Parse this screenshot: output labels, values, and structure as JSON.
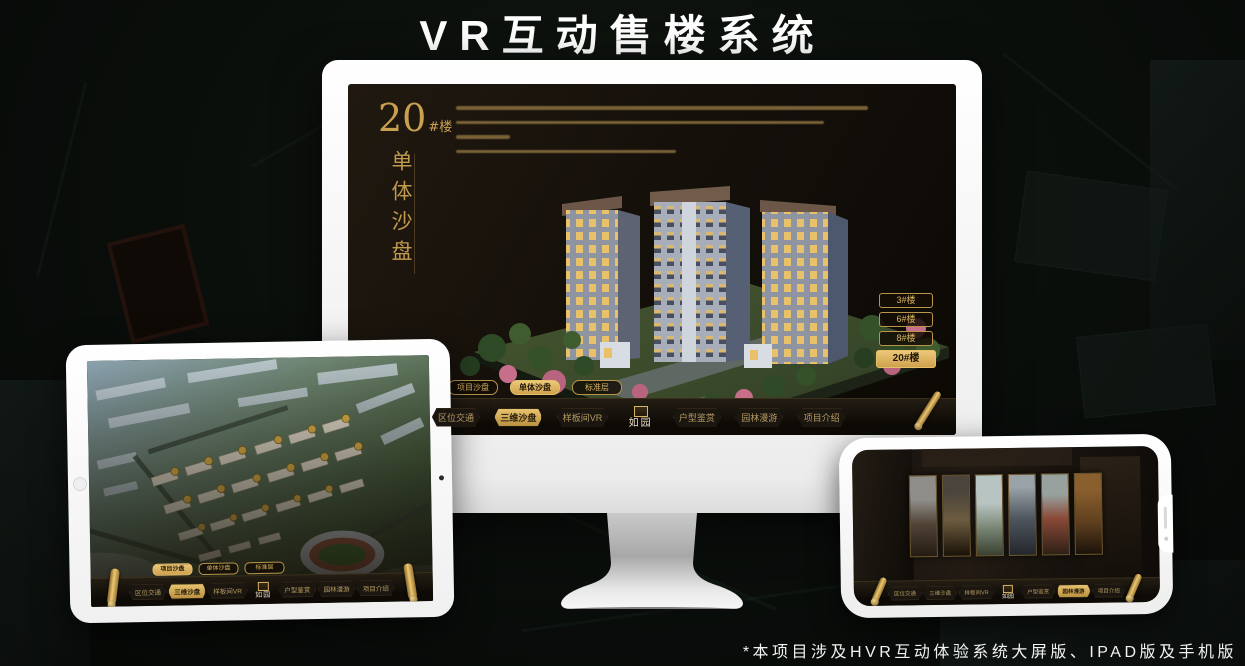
{
  "page": {
    "title": "VR互动售楼系统",
    "footer_note": "*本项目涉及HVR互动体验系统大屏版、IPAD版及手机版"
  },
  "colors": {
    "gold": "#c9a050",
    "gold_bright": "#eac873",
    "app_background": "#17110a",
    "device_white": "#f5f5f5",
    "title_white": "#ffffff"
  },
  "brand": {
    "logo_text": "如园"
  },
  "icons": {
    "nav_end_monitor": "gold-scroll-quill",
    "nav_end_tablet": "gold-scroll-pillar",
    "nav_end_phone": "gold-scroll-pillar"
  },
  "monitor_app": {
    "title_number": "20",
    "title_suffix": "#楼",
    "title_vertical": "单体沙盘",
    "floor_buttons": [
      "3#楼",
      "6#楼",
      "8#楼",
      "20#楼"
    ],
    "selected_floor": "20#楼",
    "sub_tabs": [
      "项目沙盘",
      "单体沙盘",
      "标准层"
    ],
    "selected_sub_tab": "单体沙盘",
    "nav_items": [
      "区位交通",
      "三维沙盘",
      "样板间VR",
      "户型鉴赏",
      "园林漫游",
      "项目介绍"
    ],
    "selected_nav": "三维沙盘"
  },
  "tablet_app": {
    "sub_tabs": [
      "项目沙盘",
      "单体沙盘",
      "标准层"
    ],
    "selected_sub_tab": "项目沙盘",
    "nav_items": [
      "区位交通",
      "三维沙盘",
      "样板间VR",
      "户型鉴赏",
      "园林漫游",
      "项目介绍"
    ],
    "selected_nav": "三维沙盘"
  },
  "phone_app": {
    "nav_items": [
      "区位交通",
      "三维沙盘",
      "样板间VR",
      "户型鉴赏",
      "园林漫游",
      "项目介绍"
    ],
    "selected_nav": "园林漫游"
  }
}
